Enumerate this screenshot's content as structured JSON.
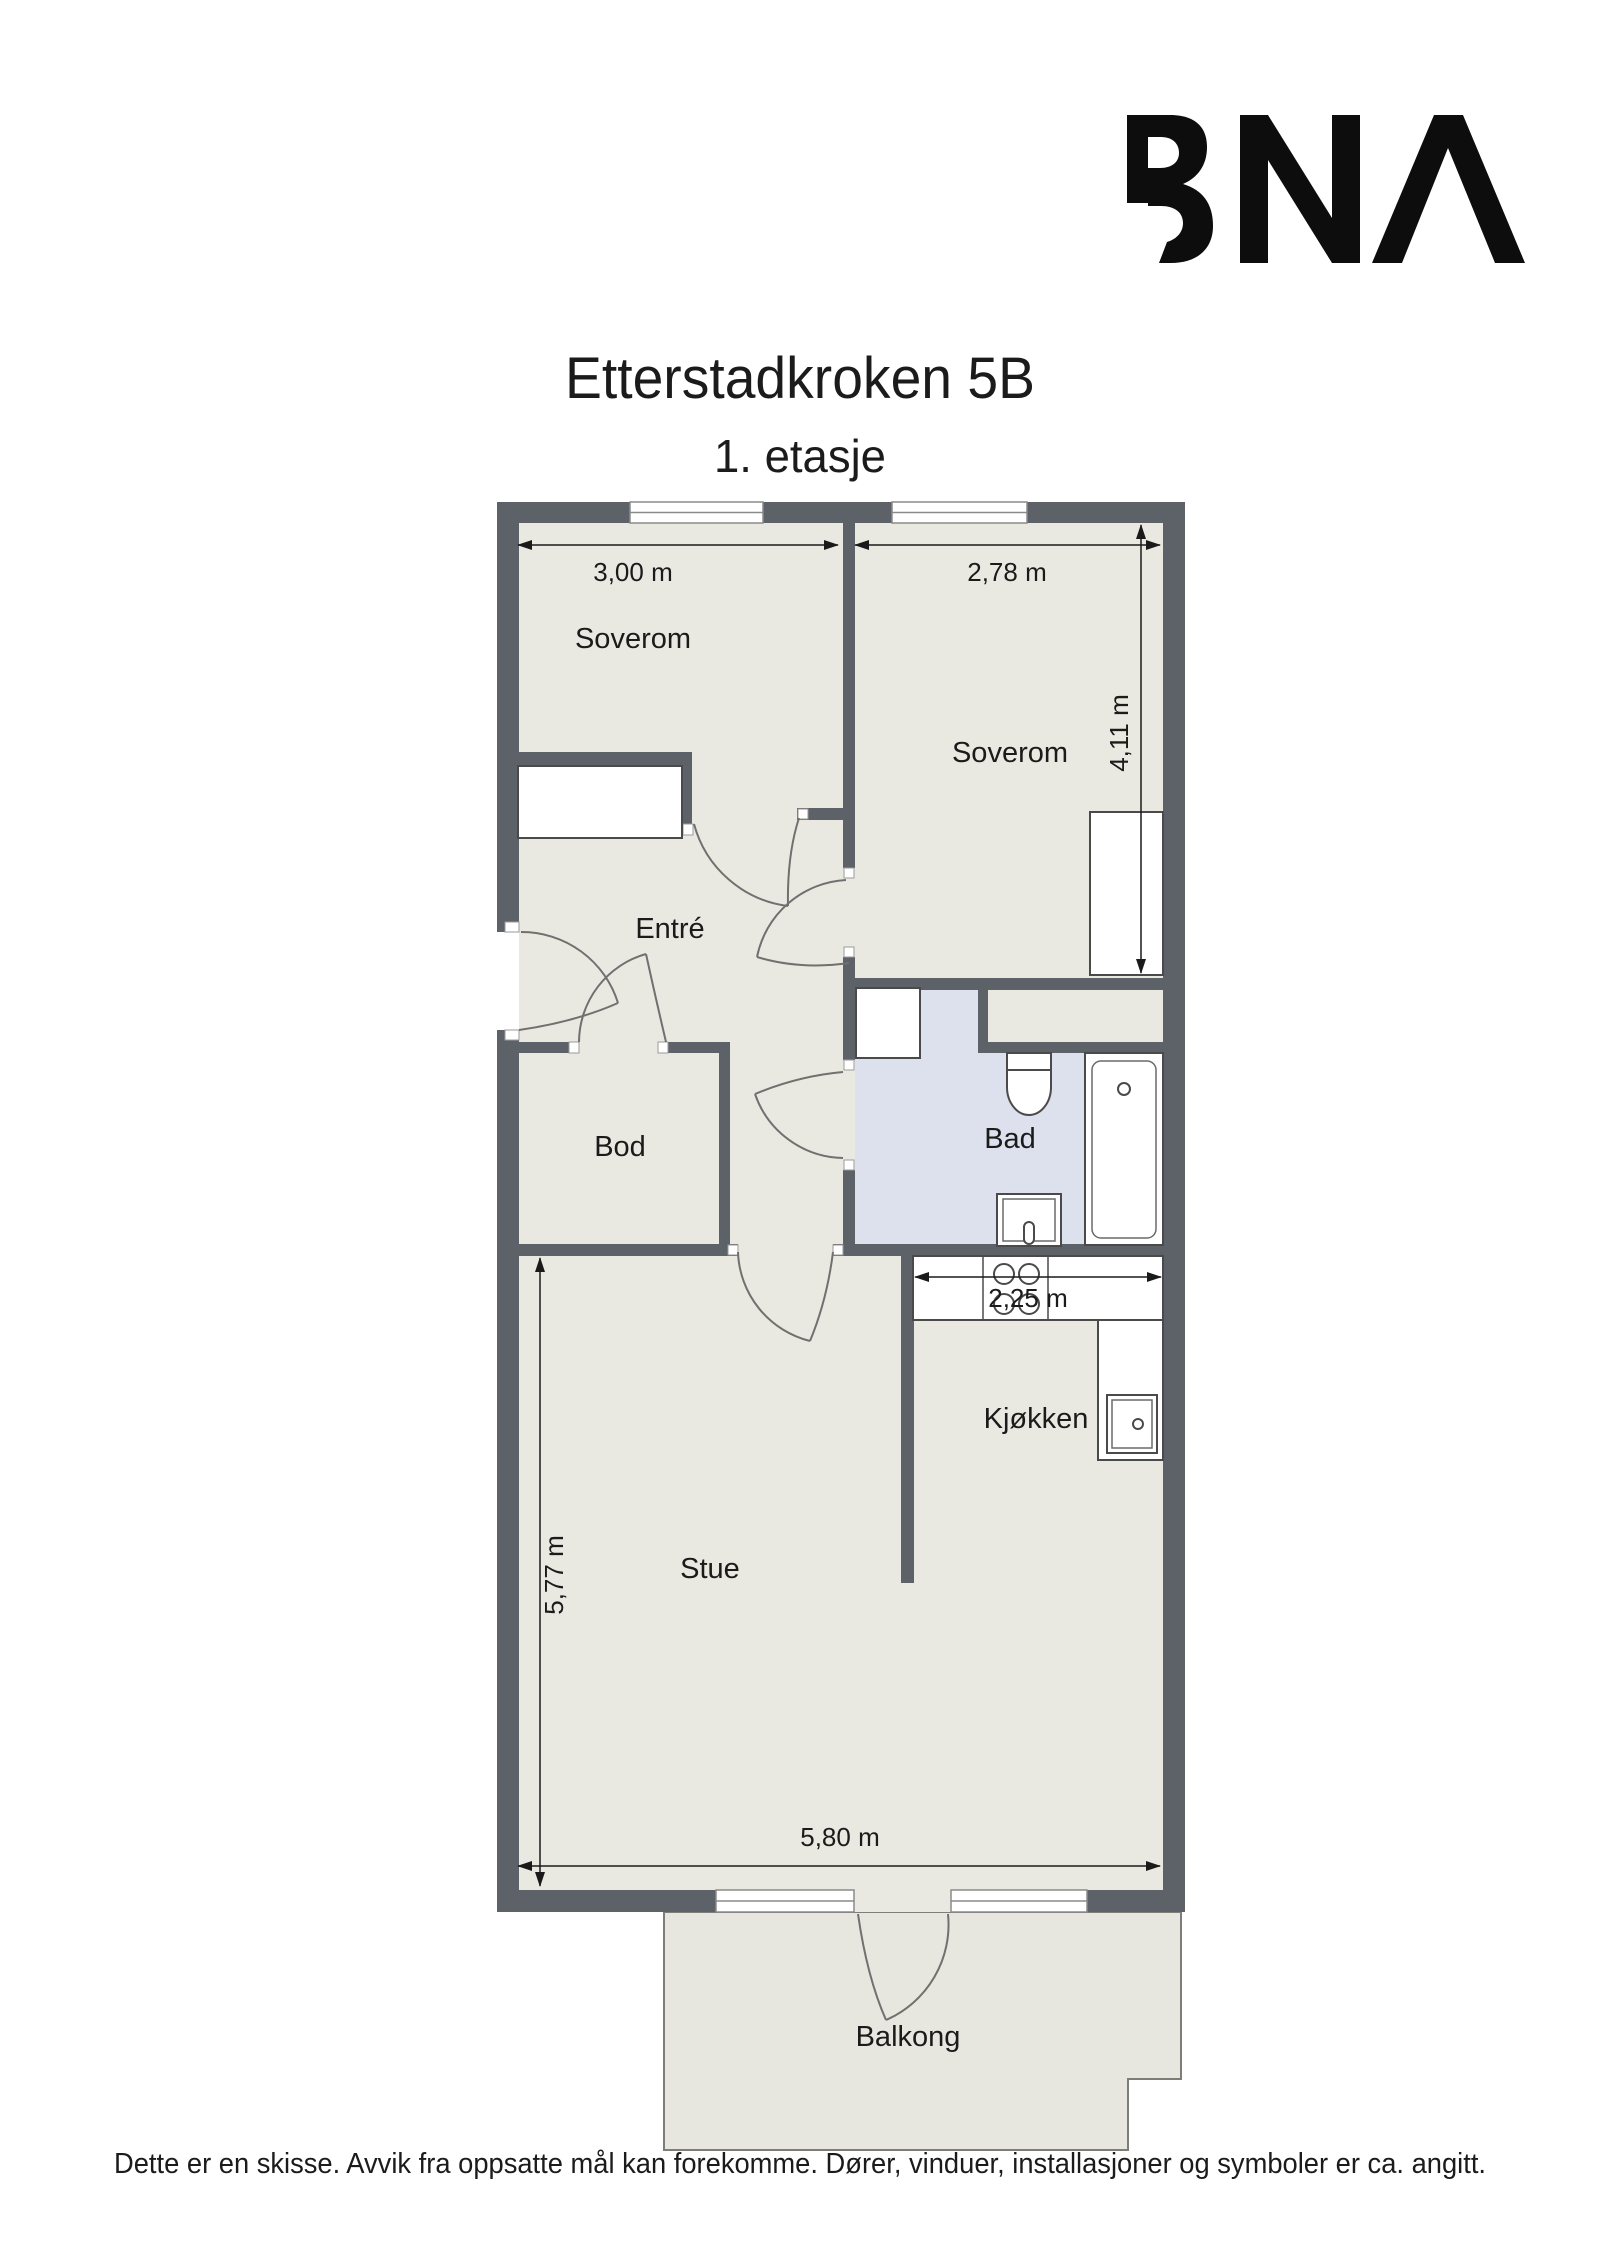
{
  "page": {
    "logo": {
      "name": "bna-logo",
      "text": "BNA"
    },
    "title": "Etterstadkroken 5B",
    "subtitle": "1. etasje",
    "disclaimer": "Dette er en skisse. Avvik fra oppsatte mål kan forekomme. Dører, vinduer, installasjoner og symboler er ca. angitt."
  },
  "plan": {
    "rooms": {
      "soverom1": {
        "label": "Soverom",
        "width_dim": "3,00 m"
      },
      "soverom2": {
        "label": "Soverom",
        "width_dim": "2,78 m",
        "height_dim": "4,11 m"
      },
      "entre": {
        "label": "Entré"
      },
      "bod": {
        "label": "Bod"
      },
      "bad": {
        "label": "Bad"
      },
      "kjokken": {
        "label": "Kjøkken",
        "width_dim": "2,25 m"
      },
      "stue": {
        "label": "Stue",
        "height_dim": "5,77 m",
        "width_dim": "5,80 m"
      },
      "balkong": {
        "label": "Balkong"
      }
    },
    "fixtures": [
      "wardrobe",
      "wardrobe",
      "washing-machine",
      "toilet",
      "bathtub",
      "sink",
      "stove",
      "kitchen-sink"
    ],
    "colors": {
      "wall": "#5d6269",
      "floor": "#eae9e1",
      "bathroom_floor": "#dce1ed",
      "balcony_floor": "#e7e7df",
      "dimension": "#1a1a1a",
      "logo": "#0d0d0d"
    }
  }
}
